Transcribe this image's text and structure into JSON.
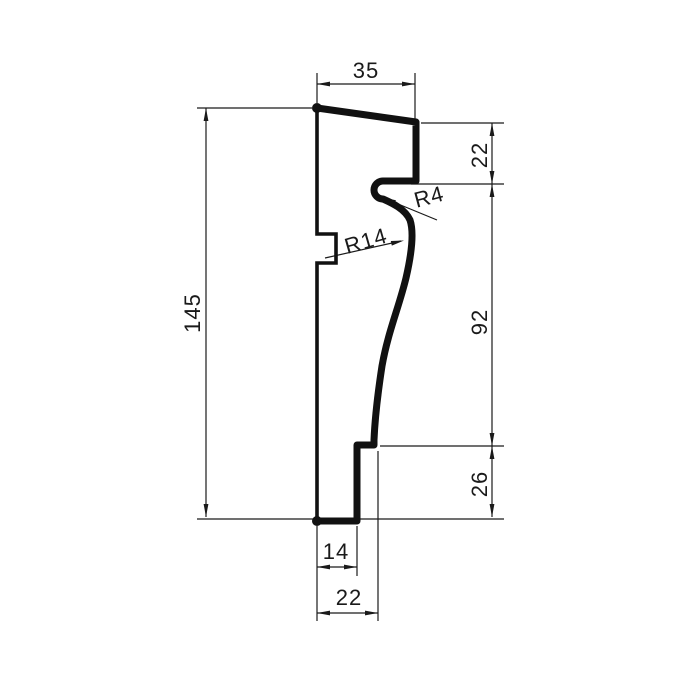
{
  "drawing": {
    "type": "technical-profile-cross-section",
    "background_color": "#ffffff",
    "outline_color": "#111111",
    "dimension_color": "#1a1a1a",
    "dimensions": {
      "top_width": "35",
      "left_total_height": "145",
      "right_upper": "22",
      "right_middle": "92",
      "right_lower": "26",
      "bottom_inner_width": "14",
      "bottom_outer_width": "22",
      "radius_small": "R4",
      "radius_large": "R14"
    }
  }
}
